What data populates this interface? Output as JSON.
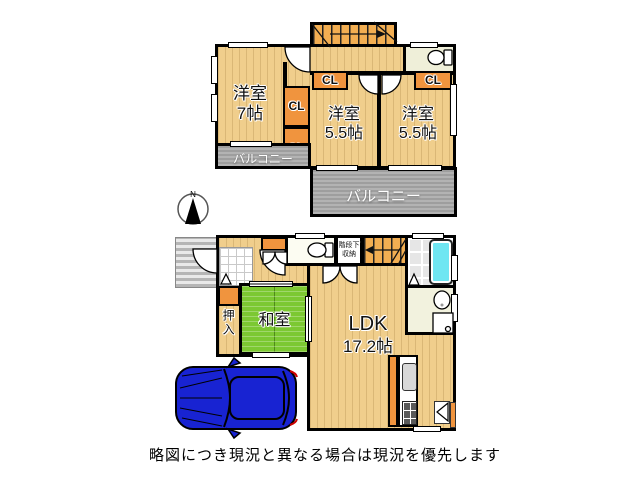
{
  "caption": "略図につき現況と異なる場合は現況を優先します",
  "compass": {
    "north_label": "N"
  },
  "floor2": {
    "room_west7": {
      "name": "洋室",
      "size": "7帖"
    },
    "room_center55": {
      "name": "洋室",
      "size": "5.5帖"
    },
    "room_east55": {
      "name": "洋室",
      "size": "5.5帖"
    },
    "closet_label": "CL",
    "balcony_west_label": "バルコニー",
    "balcony_south_label": "バルコニー"
  },
  "floor1": {
    "tatami_room": {
      "name": "和室"
    },
    "ldk": {
      "name": "LDK",
      "size": "17.2帖"
    },
    "oshiire_label": "押入",
    "under_stair_storage": {
      "line1": "階段下",
      "line2": "収納"
    }
  },
  "colors": {
    "background": "#ffffff",
    "wall": "#000000",
    "wood_floor": "#F0CE8C",
    "closet_orange": "#F0943E",
    "tatami_green": "#7CC832",
    "balcony_gray": "#9E9E9E",
    "bathtub_cyan": "#6FE6F2",
    "car_blue": "#1823D2"
  }
}
